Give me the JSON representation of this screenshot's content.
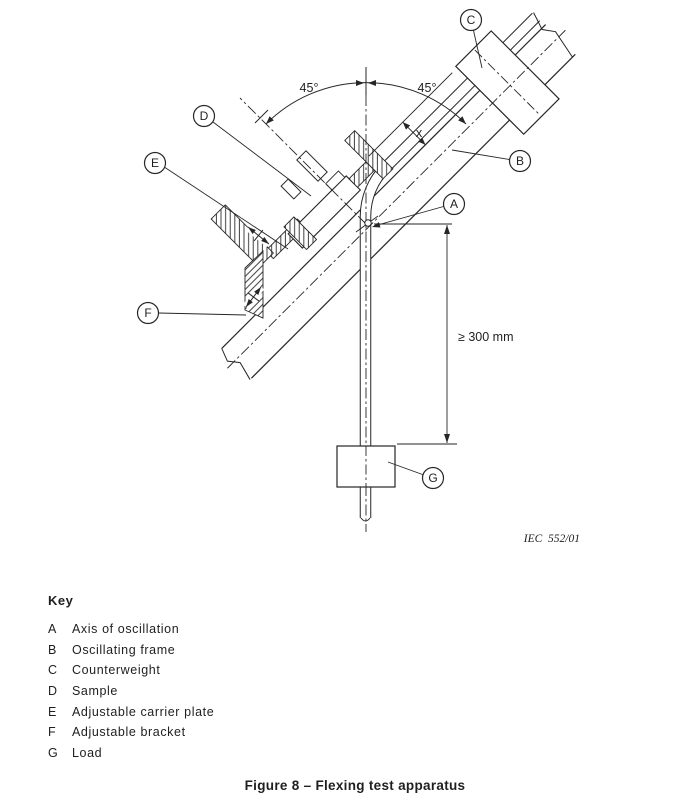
{
  "figure": {
    "caption": "Figure 8 – Flexing test apparatus",
    "drawing_ref": "IEC  552/01",
    "labels": {
      "angle_left": "45°",
      "angle_right": "45°",
      "x_dim": "x",
      "min_hang_length": "≥ 300 mm"
    }
  },
  "balloons": [
    "A",
    "B",
    "C",
    "D",
    "E",
    "F",
    "G"
  ],
  "key": {
    "title": "Key",
    "items": [
      {
        "letter": "A",
        "label": "Axis of oscillation"
      },
      {
        "letter": "B",
        "label": "Oscillating frame"
      },
      {
        "letter": "C",
        "label": "Counterweight"
      },
      {
        "letter": "D",
        "label": "Sample"
      },
      {
        "letter": "E",
        "label": "Adjustable carrier plate"
      },
      {
        "letter": "F",
        "label": "Adjustable bracket"
      },
      {
        "letter": "G",
        "label": "Load"
      }
    ]
  }
}
